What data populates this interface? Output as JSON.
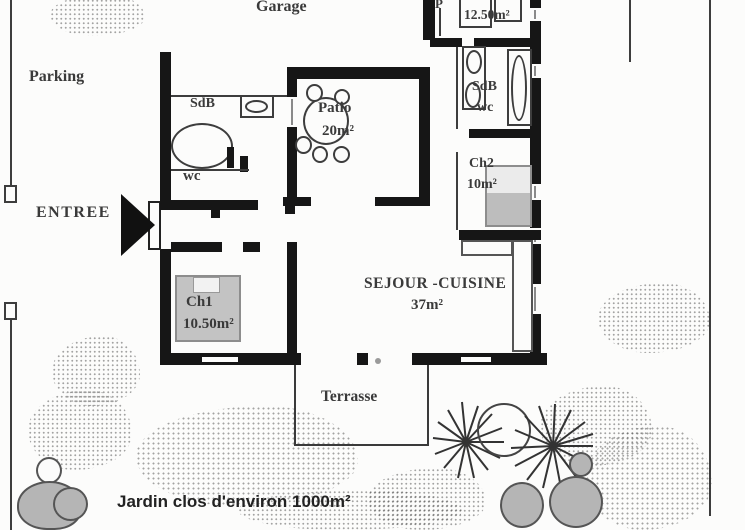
{
  "plan_title": "Maison plain-pied – plan",
  "colors": {
    "wall": "#161616",
    "line": "#3d3d3d",
    "text": "#3a3a3a",
    "furniture_gray": "#c3c3c3",
    "shrub_gray": "#b5b5b5",
    "background": "#fcfcfb"
  },
  "rooms": {
    "garage": {
      "label": "Garage"
    },
    "upper_room": {
      "partial_label": "P",
      "area": "12.50m²"
    },
    "bathroom_left": {
      "label": "SdB"
    },
    "toilet_left": {
      "label": "wc"
    },
    "patio": {
      "label": "Patio",
      "area": "20m²"
    },
    "bathroom_right": {
      "label": "SdB",
      "sublabel": "wc"
    },
    "bedroom2": {
      "label": "Ch2",
      "area": "10m²"
    },
    "bedroom1": {
      "label": "Ch1",
      "area": "10.50m²"
    },
    "living_kitchen": {
      "label": "SEJOUR -CUISINE",
      "area": "37m²"
    },
    "terrace": {
      "label": "Terrasse"
    }
  },
  "outdoor": {
    "parking": {
      "label": "Parking"
    },
    "entrance": {
      "label": "ENTREE"
    },
    "garden": {
      "label": "Jardin clos d'environ 1000m²"
    }
  }
}
